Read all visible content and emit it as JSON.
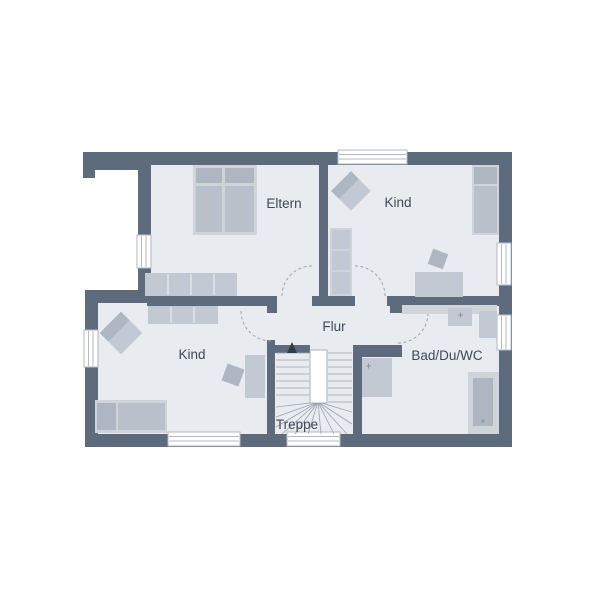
{
  "plan": {
    "rooms": [
      {
        "id": "eltern",
        "label": "Eltern"
      },
      {
        "id": "kind_top_right",
        "label": "Kind"
      },
      {
        "id": "flur",
        "label": "Flur"
      },
      {
        "id": "kind_bottom_left",
        "label": "Kind"
      },
      {
        "id": "bad_du_wc",
        "label": "Bad/Du/WC"
      },
      {
        "id": "treppe",
        "label": "Treppe"
      }
    ],
    "colors": {
      "background": "#ffffff",
      "wall": "#5e6b7c",
      "floor": "#e8ebef",
      "furniture": "#c2c9d2",
      "furniture_light": "#ced4da",
      "furniture_mid": "#b9c0ca",
      "furniture_dark": "#adb6c1",
      "line": "#9aa3ae",
      "window": "#ffffff",
      "window_frame": "#b2bac3",
      "text": "#3f4956"
    }
  }
}
